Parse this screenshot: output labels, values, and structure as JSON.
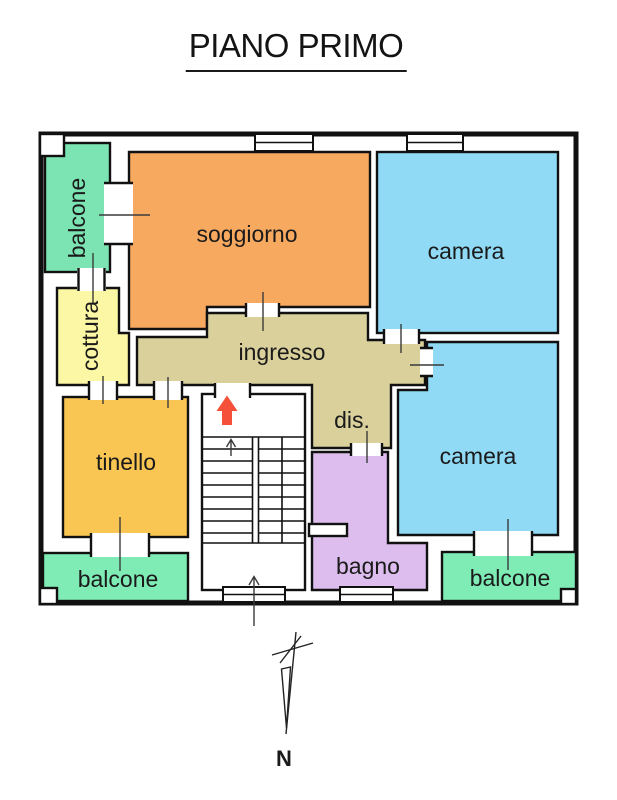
{
  "title": "PIANO PRIMO",
  "rooms": {
    "balcone_tl": {
      "label": "balcone",
      "color": "#7ce4b3"
    },
    "soggiorno": {
      "label": "soggiorno",
      "color": "#f8a960"
    },
    "camera_top": {
      "label": "camera",
      "color": "#90daf6"
    },
    "cottura": {
      "label": "cottura",
      "color": "#fbf7a4"
    },
    "ingresso": {
      "label": "ingresso",
      "color": "#d9d09c"
    },
    "dis": {
      "label": "dis."
    },
    "tinello": {
      "label": "tinello",
      "color": "#f9c553"
    },
    "bagno": {
      "label": "bagno",
      "color": "#dcbded"
    },
    "camera_bottom": {
      "label": "camera",
      "color": "#90daf6"
    },
    "balcone_bl": {
      "label": "balcone",
      "color": "#7fecb6"
    },
    "balcone_br": {
      "label": "balcone",
      "color": "#7fecb6"
    }
  },
  "entrance": {
    "arrow_color": "#f4503a"
  },
  "compass": {
    "north_label": "N"
  },
  "palette": {
    "wall": "#111111",
    "tick": "#3a3a3a",
    "background": "#ffffff"
  }
}
